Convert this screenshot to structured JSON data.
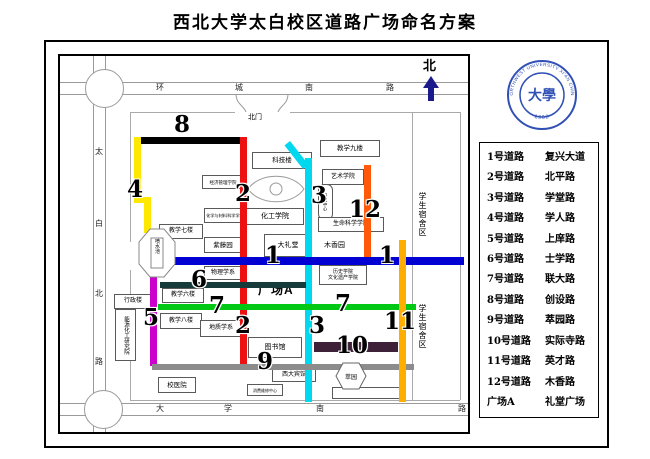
{
  "title": "西北大学太白校区道路广场命名方案",
  "compass": {
    "north_label": "北"
  },
  "logo": {
    "ring_text": "NORTHWEST UNIVERSITY XI'AN CHINA",
    "year_text": "· 1902 ·",
    "center_text": "大學"
  },
  "legend": {
    "rows": [
      {
        "id": "1号道路",
        "name": "复兴大道"
      },
      {
        "id": "2号道路",
        "name": "北平路"
      },
      {
        "id": "3号道路",
        "name": "学堂路"
      },
      {
        "id": "4号道路",
        "name": "学人路"
      },
      {
        "id": "5号道路",
        "name": "上庠路"
      },
      {
        "id": "6号道路",
        "name": "士学路"
      },
      {
        "id": "7号道路",
        "name": "联大路"
      },
      {
        "id": "8号道路",
        "name": "创设路"
      },
      {
        "id": "9号道路",
        "name": "萃园路"
      },
      {
        "id": "10号道路",
        "name": "实际寺路"
      },
      {
        "id": "11号道路",
        "name": "英才路"
      },
      {
        "id": "12号道路",
        "name": "木香路"
      },
      {
        "id": "广场A",
        "name": "礼堂广场"
      }
    ]
  },
  "outer_roads": {
    "top": [
      "环",
      "城",
      "南",
      "路"
    ],
    "left": [
      "太",
      "白",
      "北",
      "路"
    ],
    "bottom": [
      "大",
      "学",
      "南",
      "路"
    ]
  },
  "gates": {
    "north": "北门",
    "west": "西门"
  },
  "labels": {
    "plaza": "广场A",
    "dorm_upper": "学生宿舍区",
    "dorm_lower": "学生宿舍区",
    "muxiangyuan": "木香园",
    "cuiyuan": "萃园",
    "fountain": "喷水池"
  },
  "buildings": {
    "keji": "科技楼",
    "jiaoxue9": "教学九楼",
    "jingguan": "经济管理学院",
    "huacai": "化学与材料科学学院",
    "huagong": "化工学院",
    "jiaoxue7": "教学七楼",
    "ziteng": "紫藤园",
    "dalitang": "大礼堂",
    "yishu": "艺术学院",
    "yanjiu": "研究中心",
    "shengming": "生命科学学院",
    "lishi_line1": "历史学院",
    "lishi_line2": "文化遗产学院",
    "wuli": "物理学系",
    "jiaoxue6": "教学六楼",
    "xingzheng": "行政楼",
    "nengyuan": "能源化工研究院",
    "jiaoxue8": "教学八楼",
    "dizhi": "地质学系",
    "tushuguan": "图书馆",
    "xidabinguan": "西大宾馆",
    "xiaoyiyuan": "校医院",
    "weixiu": "消费维修中心"
  },
  "road_numbers": {
    "n1": "1",
    "n2": "2",
    "n3": "3",
    "n4": "4",
    "n5": "5",
    "n6": "6",
    "n7": "7",
    "n8": "8",
    "n9": "9",
    "n10": "10",
    "n11": "11",
    "n12": "12"
  },
  "road_colors": {
    "r1": "#0000D2",
    "r2": "#EE1111",
    "r3": "#00D8F0",
    "r4": "#FFE800",
    "r5": "#CC00CC",
    "r6": "#173A3A",
    "r7": "#00C814",
    "r8": "#000000",
    "r9": "#8C8C8C",
    "r10": "#3D2138",
    "r11": "#FFAE00",
    "r12": "#FF5A0A"
  },
  "ui_colors": {
    "logo_blue": "#3150B5",
    "north_arrow": "#1A1A8C"
  }
}
